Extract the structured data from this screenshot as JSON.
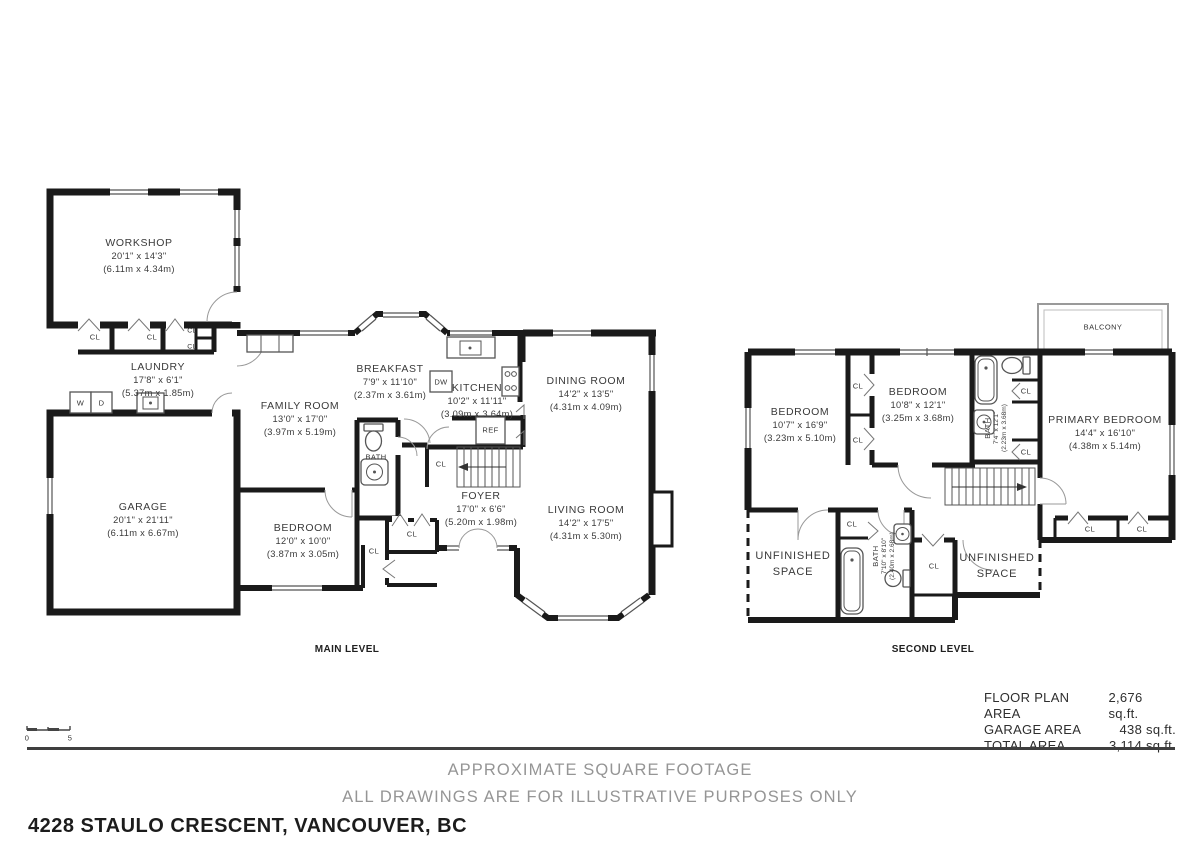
{
  "address": "4228 STAULO CRESCENT, VANCOUVER, BC",
  "disclaimer": {
    "line1": "APPROXIMATE SQUARE FOOTAGE",
    "line2": "ALL DRAWINGS ARE FOR ILLUSTRATIVE PURPOSES ONLY"
  },
  "areas": [
    {
      "label": "FLOOR PLAN AREA",
      "value": "2,676 sq.ft."
    },
    {
      "label": "GARAGE AREA",
      "value": "438 sq.ft."
    },
    {
      "label": "TOTAL AREA",
      "value": "3,114 sq.ft."
    }
  ],
  "scale_bar": {
    "start": "0",
    "end": "5"
  },
  "levels": {
    "main": {
      "name": "MAIN LEVEL",
      "rooms": {
        "workshop": {
          "name": "WORKSHOP",
          "imperial": "20'1\" x 14'3\"",
          "metric": "(6.11m x 4.34m)"
        },
        "laundry": {
          "name": "LAUNDRY",
          "imperial": "17'8\" x 6'1\"",
          "metric": "(5.37m x 1.85m)"
        },
        "garage": {
          "name": "GARAGE",
          "imperial": "20'1\" x 21'11\"",
          "metric": "(6.11m x 6.67m)"
        },
        "family": {
          "name": "FAMILY ROOM",
          "imperial": "13'0\" x 17'0\"",
          "metric": "(3.97m x 5.19m)"
        },
        "breakfast": {
          "name": "BREAKFAST",
          "imperial": "7'9\" x 11'10\"",
          "metric": "(2.37m x 3.61m)"
        },
        "kitchen": {
          "name": "KITCHEN",
          "imperial": "10'2\" x 11'11\"",
          "metric": "(3.09m x 3.64m)"
        },
        "dining": {
          "name": "DINING ROOM",
          "imperial": "14'2\" x 13'5\"",
          "metric": "(4.31m x 4.09m)"
        },
        "living": {
          "name": "LIVING ROOM",
          "imperial": "14'2\" x 17'5\"",
          "metric": "(4.31m x 5.30m)"
        },
        "bedroom": {
          "name": "BEDROOM",
          "imperial": "12'0\" x 10'0\"",
          "metric": "(3.87m x 3.05m)"
        },
        "foyer": {
          "name": "FOYER",
          "imperial": "17'0\" x 6'6\"",
          "metric": "(5.20m x 1.98m)"
        },
        "bath": {
          "name": "BATH"
        }
      }
    },
    "second": {
      "name": "SECOND LEVEL",
      "rooms": {
        "bedroom_left": {
          "name": "BEDROOM",
          "imperial": "10'7\" x 16'9\"",
          "metric": "(3.23m x 5.10m)"
        },
        "bedroom_mid": {
          "name": "BEDROOM",
          "imperial": "10'8\" x 12'1\"",
          "metric": "(3.25m x 3.68m)"
        },
        "primary": {
          "name": "PRIMARY BEDROOM",
          "imperial": "14'4\" x 16'10\"",
          "metric": "(4.38m x 5.14m)"
        },
        "bath_top": {
          "name": "BATH",
          "imperial": "7'4\" x 12'1\"",
          "metric": "(2.23m x 3.68m)"
        },
        "bath_bottom": {
          "name": "BATH",
          "imperial": "7'10\" x 8'10\"",
          "metric": "(2.40m x 2.68m)"
        },
        "unfinished_left": {
          "line1": "UNFINISHED",
          "line2": "SPACE"
        },
        "unfinished_right": {
          "line1": "UNFINISHED",
          "line2": "SPACE"
        },
        "balcony": {
          "name": "BALCONY"
        }
      }
    }
  },
  "fixtures": {
    "closet": "CL",
    "washer": "W",
    "dryer": "D",
    "dishwasher": "DW",
    "refrigerator": "REF"
  }
}
